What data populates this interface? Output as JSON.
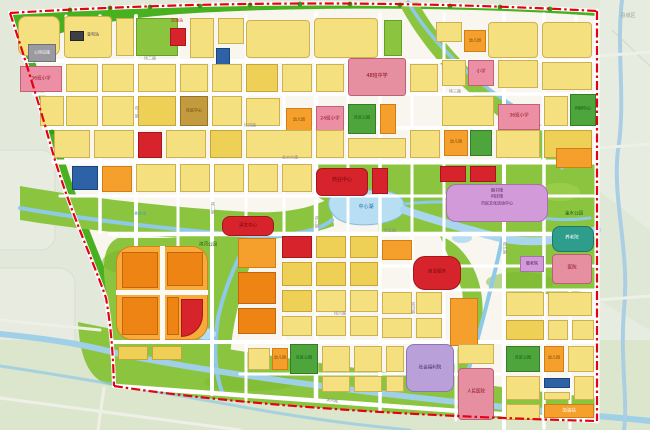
{
  "map": {
    "outside_region_label": "县城区",
    "boundary_color": "#e60014",
    "water_color": "#8fc9e8",
    "lake_color": "#b7def2",
    "park_color": "#8bc53f",
    "green_belt_color": "#49b11f",
    "road_color": "#ffffff",
    "palette": {
      "Y": {
        "f": "#f4e07e",
        "b": "#cdb052"
      },
      "Y2": {
        "f": "#edd055",
        "b": "#c7a53a"
      },
      "O": {
        "f": "#f5a02c",
        "b": "#cf7d14"
      },
      "O2": {
        "f": "#ee8413",
        "b": "#c6660a"
      },
      "OG": {
        "f": "#f6ab3a",
        "b": "#d3851c"
      },
      "R": {
        "f": "#d7232b",
        "b": "#a5161d"
      },
      "P": {
        "f": "#ec8fa4",
        "b": "#c2607a"
      },
      "RO": {
        "f": "#e58fa0",
        "b": "#bc5f77"
      },
      "PU": {
        "f": "#b9a0d9",
        "b": "#8e74b5"
      },
      "V": {
        "f": "#d29ad8",
        "b": "#a86fb0"
      },
      "T": {
        "f": "#2f9d8c",
        "b": "#1f7568"
      },
      "BR": {
        "f": "#c49a3f",
        "b": "#97732a"
      },
      "G": {
        "f": "#8bc53f",
        "b": "#63a024"
      },
      "G2": {
        "f": "#4ea53c",
        "b": "#347c27"
      },
      "B": {
        "f": "#2d62a7",
        "b": "#1c4479"
      },
      "GY": {
        "f": "#9a9aa0",
        "b": "#6f6f75"
      },
      "GYD": {
        "f": "#3f3f46",
        "b": "#222222"
      },
      "W": {
        "f": "#fbfaf5",
        "b": "transparent"
      }
    },
    "parcels": [
      [
        18,
        16,
        42,
        40,
        "Y",
        8
      ],
      [
        64,
        16,
        48,
        42,
        "Y",
        4,
        "h"
      ],
      [
        70,
        31,
        14,
        10,
        "GYD"
      ],
      [
        116,
        18,
        18,
        38,
        "Y"
      ],
      [
        136,
        18,
        42,
        38,
        "G"
      ],
      [
        170,
        28,
        16,
        18,
        "R"
      ],
      [
        190,
        18,
        24,
        40,
        "Y"
      ],
      [
        218,
        18,
        26,
        26,
        "Y"
      ],
      [
        216,
        48,
        14,
        20,
        "B"
      ],
      [
        246,
        20,
        64,
        38,
        "Y",
        4,
        "h"
      ],
      [
        314,
        18,
        64,
        40,
        "Y",
        4,
        "h"
      ],
      [
        384,
        20,
        18,
        36,
        "G"
      ],
      [
        436,
        22,
        26,
        20,
        "Y"
      ],
      [
        464,
        30,
        22,
        22,
        "O"
      ],
      [
        488,
        22,
        50,
        36,
        "Y",
        4,
        "h"
      ],
      [
        542,
        22,
        50,
        36,
        "Y",
        4,
        "h"
      ],
      [
        28,
        44,
        28,
        18,
        "GY"
      ],
      [
        20,
        66,
        42,
        26,
        "P"
      ],
      [
        66,
        64,
        32,
        28,
        "Y"
      ],
      [
        102,
        64,
        32,
        28,
        "Y"
      ],
      [
        138,
        64,
        38,
        28,
        "Y"
      ],
      [
        180,
        64,
        28,
        28,
        "Y"
      ],
      [
        212,
        64,
        30,
        28,
        "Y"
      ],
      [
        246,
        64,
        32,
        28,
        "Y2"
      ],
      [
        282,
        64,
        30,
        28,
        "Y"
      ],
      [
        316,
        64,
        28,
        28,
        "Y"
      ],
      [
        348,
        58,
        58,
        38,
        "RO",
        3
      ],
      [
        410,
        64,
        28,
        28,
        "Y"
      ],
      [
        442,
        60,
        24,
        26,
        "Y"
      ],
      [
        468,
        60,
        26,
        26,
        "P"
      ],
      [
        498,
        60,
        40,
        28,
        "Y"
      ],
      [
        542,
        62,
        50,
        28,
        "Y",
        0,
        "h"
      ],
      [
        40,
        96,
        24,
        30,
        "Y"
      ],
      [
        66,
        96,
        32,
        30,
        "Y"
      ],
      [
        102,
        96,
        32,
        30,
        "Y"
      ],
      [
        138,
        96,
        38,
        30,
        "Y2"
      ],
      [
        180,
        96,
        28,
        30,
        "BR"
      ],
      [
        212,
        96,
        30,
        30,
        "Y"
      ],
      [
        246,
        98,
        34,
        28,
        "Y"
      ],
      [
        286,
        108,
        26,
        26,
        "O"
      ],
      [
        316,
        106,
        28,
        28,
        "P"
      ],
      [
        348,
        104,
        28,
        30,
        "G2"
      ],
      [
        380,
        104,
        16,
        30,
        "O"
      ],
      [
        442,
        96,
        52,
        30,
        "Y",
        0,
        "h"
      ],
      [
        498,
        104,
        42,
        26,
        "P"
      ],
      [
        544,
        96,
        24,
        30,
        "Y"
      ],
      [
        570,
        94,
        26,
        32,
        "G2"
      ],
      [
        54,
        130,
        36,
        28,
        "Y"
      ],
      [
        94,
        130,
        40,
        28,
        "Y"
      ],
      [
        138,
        132,
        24,
        26,
        "R"
      ],
      [
        166,
        130,
        40,
        28,
        "Y"
      ],
      [
        210,
        130,
        32,
        28,
        "Y2"
      ],
      [
        246,
        130,
        66,
        28,
        "Y",
        0,
        "h"
      ],
      [
        316,
        130,
        28,
        28,
        "Y"
      ],
      [
        348,
        138,
        58,
        20,
        "Y"
      ],
      [
        410,
        130,
        30,
        28,
        "Y"
      ],
      [
        444,
        130,
        24,
        26,
        "O"
      ],
      [
        470,
        130,
        22,
        26,
        "G2"
      ],
      [
        496,
        130,
        44,
        28,
        "Y"
      ],
      [
        544,
        130,
        48,
        28,
        "Y2"
      ],
      [
        72,
        166,
        26,
        24,
        "B"
      ],
      [
        102,
        166,
        30,
        26,
        "O"
      ],
      [
        136,
        164,
        40,
        28,
        "Y"
      ],
      [
        180,
        164,
        30,
        28,
        "Y"
      ],
      [
        214,
        164,
        30,
        28,
        "Y"
      ],
      [
        248,
        164,
        30,
        28,
        "Y"
      ],
      [
        282,
        164,
        30,
        28,
        "Y"
      ],
      [
        316,
        168,
        52,
        28,
        "R",
        6
      ],
      [
        372,
        168,
        16,
        26,
        "R"
      ],
      [
        440,
        166,
        26,
        16,
        "R"
      ],
      [
        470,
        166,
        26,
        16,
        "R"
      ],
      [
        446,
        184,
        102,
        38,
        "V",
        10
      ],
      [
        556,
        148,
        36,
        20,
        "O"
      ],
      [
        222,
        216,
        52,
        20,
        "R",
        8
      ],
      [
        552,
        226,
        42,
        26,
        "T",
        8
      ],
      [
        520,
        256,
        24,
        16,
        "V"
      ],
      [
        552,
        254,
        40,
        30,
        "RO",
        4
      ],
      [
        116,
        246,
        92,
        94,
        "OG",
        16
      ],
      [
        116,
        290,
        92,
        5,
        "W"
      ],
      [
        160,
        246,
        5,
        94,
        "W"
      ],
      [
        122,
        252,
        36,
        36,
        "O2"
      ],
      [
        167,
        252,
        36,
        34,
        "O2"
      ],
      [
        122,
        297,
        36,
        38,
        "O2"
      ],
      [
        167,
        297,
        12,
        38,
        "O2"
      ],
      [
        181,
        299,
        22,
        38,
        "R",
        "0 0 26 0"
      ],
      [
        118,
        346,
        30,
        14,
        "Y2"
      ],
      [
        152,
        346,
        30,
        14,
        "Y2"
      ],
      [
        238,
        238,
        38,
        30,
        "O"
      ],
      [
        238,
        272,
        38,
        32,
        "O2"
      ],
      [
        238,
        308,
        38,
        26,
        "O2"
      ],
      [
        282,
        236,
        30,
        22,
        "R"
      ],
      [
        316,
        236,
        30,
        22,
        "Y2"
      ],
      [
        350,
        236,
        28,
        22,
        "Y2"
      ],
      [
        282,
        262,
        30,
        24,
        "Y2"
      ],
      [
        316,
        262,
        30,
        24,
        "Y2"
      ],
      [
        350,
        262,
        28,
        24,
        "Y2"
      ],
      [
        282,
        290,
        30,
        22,
        "Y2"
      ],
      [
        316,
        290,
        30,
        22,
        "Y"
      ],
      [
        350,
        290,
        28,
        22,
        "Y"
      ],
      [
        282,
        316,
        30,
        20,
        "Y"
      ],
      [
        316,
        316,
        30,
        20,
        "Y"
      ],
      [
        350,
        316,
        28,
        20,
        "Y"
      ],
      [
        382,
        240,
        30,
        20,
        "O"
      ],
      [
        413,
        256,
        48,
        34,
        "R",
        12
      ],
      [
        382,
        292,
        30,
        22,
        "Y"
      ],
      [
        416,
        292,
        26,
        22,
        "Y"
      ],
      [
        382,
        318,
        30,
        20,
        "Y"
      ],
      [
        416,
        318,
        26,
        20,
        "Y"
      ],
      [
        450,
        298,
        28,
        48,
        "O"
      ],
      [
        506,
        292,
        38,
        24,
        "Y"
      ],
      [
        548,
        292,
        44,
        24,
        "Y"
      ],
      [
        506,
        320,
        38,
        20,
        "Y2"
      ],
      [
        548,
        320,
        20,
        20,
        "Y"
      ],
      [
        572,
        320,
        22,
        20,
        "Y"
      ],
      [
        506,
        346,
        34,
        26,
        "G2"
      ],
      [
        544,
        346,
        20,
        26,
        "O"
      ],
      [
        568,
        346,
        26,
        26,
        "Y"
      ],
      [
        506,
        376,
        34,
        24,
        "Y"
      ],
      [
        544,
        378,
        26,
        10,
        "B"
      ],
      [
        574,
        376,
        20,
        24,
        "Y"
      ],
      [
        544,
        392,
        26,
        8,
        "Y"
      ],
      [
        506,
        404,
        34,
        16,
        "Y"
      ],
      [
        544,
        404,
        50,
        14,
        "O"
      ],
      [
        248,
        348,
        22,
        22,
        "Y"
      ],
      [
        272,
        348,
        16,
        22,
        "O"
      ],
      [
        290,
        344,
        28,
        30,
        "G2"
      ],
      [
        322,
        346,
        28,
        26,
        "Y"
      ],
      [
        354,
        346,
        28,
        26,
        "Y"
      ],
      [
        386,
        346,
        18,
        26,
        "Y"
      ],
      [
        322,
        376,
        28,
        16,
        "Y"
      ],
      [
        354,
        376,
        28,
        16,
        "Y"
      ],
      [
        386,
        376,
        18,
        16,
        "Y"
      ],
      [
        406,
        344,
        48,
        48,
        "PU",
        8
      ],
      [
        458,
        344,
        36,
        20,
        "Y"
      ],
      [
        458,
        368,
        36,
        52,
        "RO",
        4
      ]
    ],
    "labels": [
      {
        "t": "加油站",
        "x": 177,
        "y": 21,
        "c": "#cf1322",
        "s": 4
      },
      {
        "t": "变电站",
        "x": 93,
        "y": 35,
        "c": "#444444",
        "s": 4
      },
      {
        "t": "公用设施",
        "x": 42,
        "y": 53,
        "c": "#ffffff",
        "s": 4
      },
      {
        "t": "36班小学",
        "x": 41,
        "y": 79,
        "c": "#8d1320",
        "s": 4.5
      },
      {
        "t": "小学",
        "x": 481,
        "y": 72,
        "c": "#8d1320",
        "s": 4.5
      },
      {
        "t": "幼儿园",
        "x": 475,
        "y": 41,
        "c": "#7a4a00",
        "s": 4
      },
      {
        "t": "48班中学",
        "x": 377,
        "y": 77,
        "c": "#8d1320",
        "s": 5
      },
      {
        "t": "社区中心",
        "x": 194,
        "y": 111,
        "c": "#5b4300",
        "s": 4
      },
      {
        "t": "幼儿园",
        "x": 299,
        "y": 120,
        "c": "#7a4a00",
        "s": 4
      },
      {
        "t": "24班小学",
        "x": 330,
        "y": 119,
        "c": "#8d1320",
        "s": 4.5
      },
      {
        "t": "社区公园",
        "x": 362,
        "y": 118,
        "c": "#14541a",
        "s": 4
      },
      {
        "t": "36班小学",
        "x": 519,
        "y": 116,
        "c": "#8d1320",
        "s": 4.5
      },
      {
        "t": "科研中心",
        "x": 583,
        "y": 109,
        "c": "#0f4d15",
        "s": 4
      },
      {
        "t": "幼儿园",
        "x": 456,
        "y": 142,
        "c": "#7a4a00",
        "s": 4
      },
      {
        "t": "商业中心",
        "x": 342,
        "y": 181,
        "c": "#70090f",
        "s": 5
      },
      {
        "t": "商业服务",
        "x": 437,
        "y": 272,
        "c": "#70090f",
        "s": 4.5
      },
      {
        "t": "演艺中心",
        "x": 248,
        "y": 226,
        "c": "#70090f",
        "s": 4.5
      },
      {
        "t": "图书馆",
        "x": 497,
        "y": 191,
        "c": "#4d2256",
        "s": 4
      },
      {
        "t": "科技馆",
        "x": 497,
        "y": 197,
        "c": "#4d2256",
        "s": 4
      },
      {
        "t": "市民文化活动中心",
        "x": 497,
        "y": 204,
        "c": "#4d2256",
        "s": 4
      },
      {
        "t": "中心湖",
        "x": 366,
        "y": 208,
        "c": "#2b6ea0",
        "s": 5
      },
      {
        "t": "金水公园",
        "x": 574,
        "y": 214,
        "c": "#14541a",
        "s": 4.5
      },
      {
        "t": "滨河公园",
        "x": 208,
        "y": 245,
        "c": "#14541a",
        "s": 4.5
      },
      {
        "t": "养老院",
        "x": 572,
        "y": 238,
        "c": "#ffffff",
        "s": 4.5
      },
      {
        "t": "敬老院",
        "x": 532,
        "y": 264,
        "c": "#4d2256",
        "s": 4
      },
      {
        "t": "医院",
        "x": 572,
        "y": 268,
        "c": "#8d1320",
        "s": 4.5
      },
      {
        "t": "社会福利院",
        "x": 430,
        "y": 368,
        "c": "#3f2b57",
        "s": 4.5
      },
      {
        "t": "人民医院",
        "x": 476,
        "y": 392,
        "c": "#8d1320",
        "s": 4.5
      },
      {
        "t": "社区公园",
        "x": 523,
        "y": 358,
        "c": "#14541a",
        "s": 4
      },
      {
        "t": "幼儿园",
        "x": 554,
        "y": 358,
        "c": "#7a4a00",
        "s": 4
      },
      {
        "t": "社区公园",
        "x": 304,
        "y": 358,
        "c": "#14541a",
        "s": 4
      },
      {
        "t": "幼儿园",
        "x": 280,
        "y": 358,
        "c": "#7a4a00",
        "s": 4
      },
      {
        "t": "加油站",
        "x": 569,
        "y": 411,
        "c": "#ffffff",
        "s": 4.5
      },
      {
        "t": "县城区",
        "x": 628,
        "y": 17,
        "c": "#9aa49b",
        "s": 5
      },
      {
        "t": "金水大道",
        "x": 290,
        "y": 158,
        "c": "#8a8a8a",
        "s": 4
      },
      {
        "t": "纬二路",
        "x": 150,
        "y": 59,
        "c": "#8a8a8a",
        "s": 4
      },
      {
        "t": "纬三路",
        "x": 455,
        "y": 92,
        "c": "#8a8a8a",
        "s": 4
      },
      {
        "t": "纬四路",
        "x": 250,
        "y": 126,
        "c": "#8a8a8a",
        "s": 4
      },
      {
        "t": "纬五路",
        "x": 390,
        "y": 231,
        "c": "#8a8a8a",
        "s": 4
      },
      {
        "t": "纬六路",
        "x": 340,
        "y": 314,
        "c": "#8a8a8a",
        "s": 4
      },
      {
        "t": "经一路",
        "x": 136,
        "y": 112,
        "c": "#8a8a8a",
        "s": 4,
        "r": 90
      },
      {
        "t": "经二路",
        "x": 212,
        "y": 208,
        "c": "#8a8a8a",
        "s": 4,
        "r": 90
      },
      {
        "t": "经三路",
        "x": 316,
        "y": 222,
        "c": "#8a8a8a",
        "s": 4,
        "r": 90
      },
      {
        "t": "经四路",
        "x": 412,
        "y": 308,
        "c": "#8a8a8a",
        "s": 4,
        "r": 90
      },
      {
        "t": "经五路",
        "x": 504,
        "y": 248,
        "c": "#8a8a8a",
        "s": 4,
        "r": 90
      },
      {
        "t": "滨河路",
        "x": 332,
        "y": 401,
        "c": "#8a8a8a",
        "s": 4,
        "r": 7
      },
      {
        "t": "金水河",
        "x": 140,
        "y": 214,
        "c": "#4a90c4",
        "s": 4,
        "r": 4
      }
    ]
  }
}
